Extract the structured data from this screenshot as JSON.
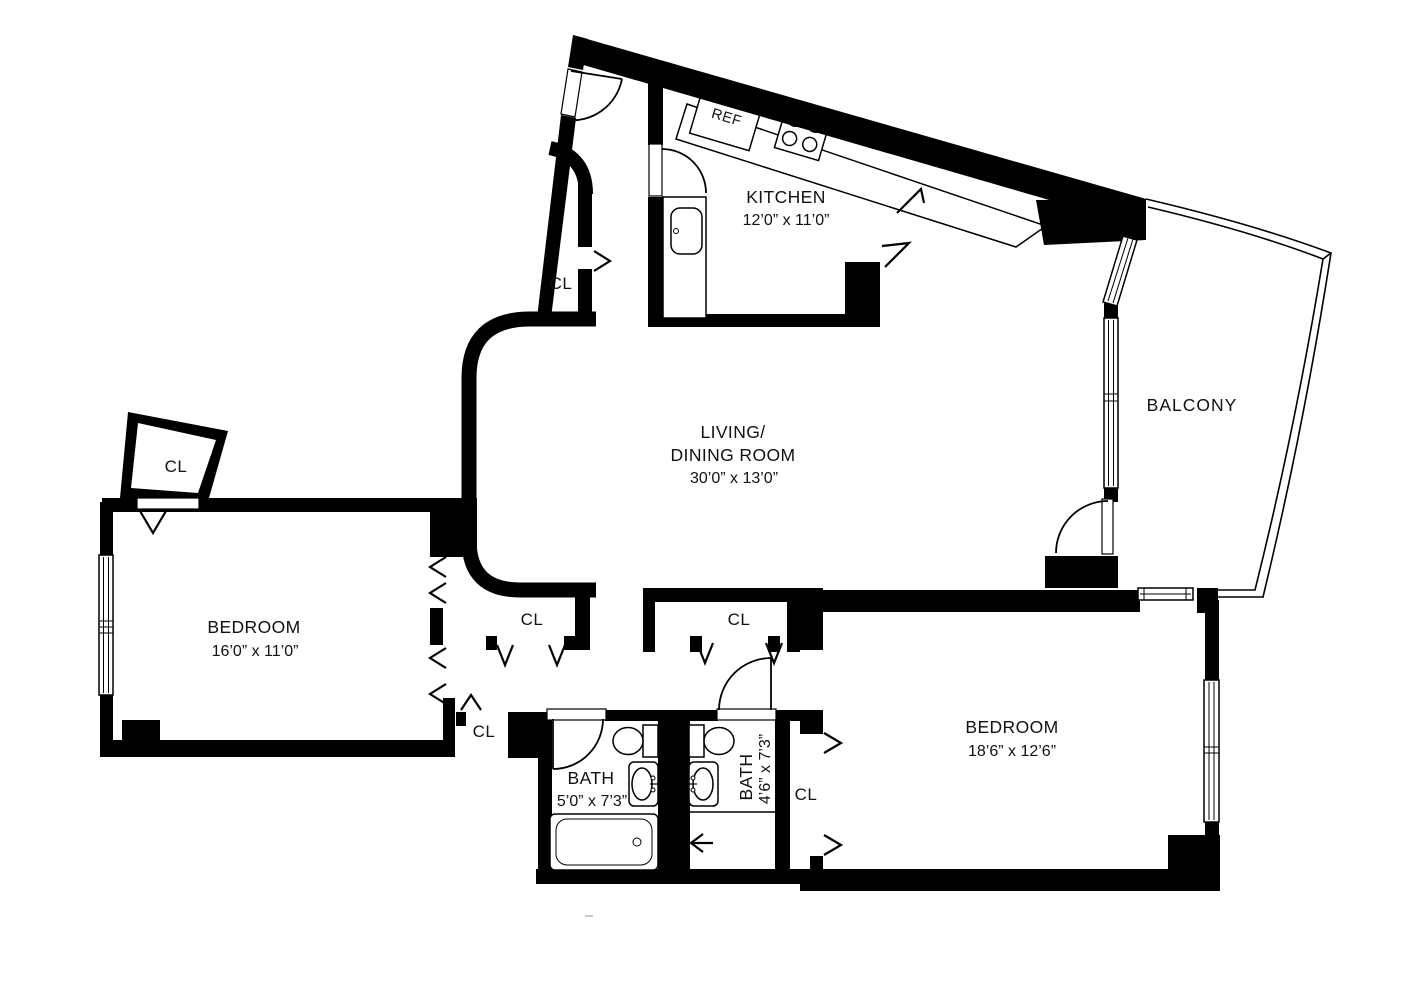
{
  "title": "Two-bedroom apartment floor plan",
  "colors": {
    "wall": "#000000",
    "background": "#ffffff",
    "text": "#111111"
  },
  "rooms": {
    "kitchen": {
      "name": "KITCHEN",
      "dims": "12’0” x 11’0”"
    },
    "living": {
      "name_line1": "LIVING/",
      "name_line2": "DINING ROOM",
      "dims": "30’0” x 13’0”"
    },
    "balcony": {
      "name": "BALCONY"
    },
    "bedroom_left": {
      "name": "BEDROOM",
      "dims": "16’0” x 11’0”"
    },
    "bedroom_right": {
      "name": "BEDROOM",
      "dims": "18’6” x 12’6”"
    },
    "bath_main": {
      "name": "BATH",
      "dims": "5’0” x 7’3”"
    },
    "bath_second": {
      "name": "BATH",
      "dims": "4’6” x 7’3”"
    }
  },
  "closets": {
    "label": "CL"
  },
  "appliances": {
    "refrigerator": "REF"
  }
}
